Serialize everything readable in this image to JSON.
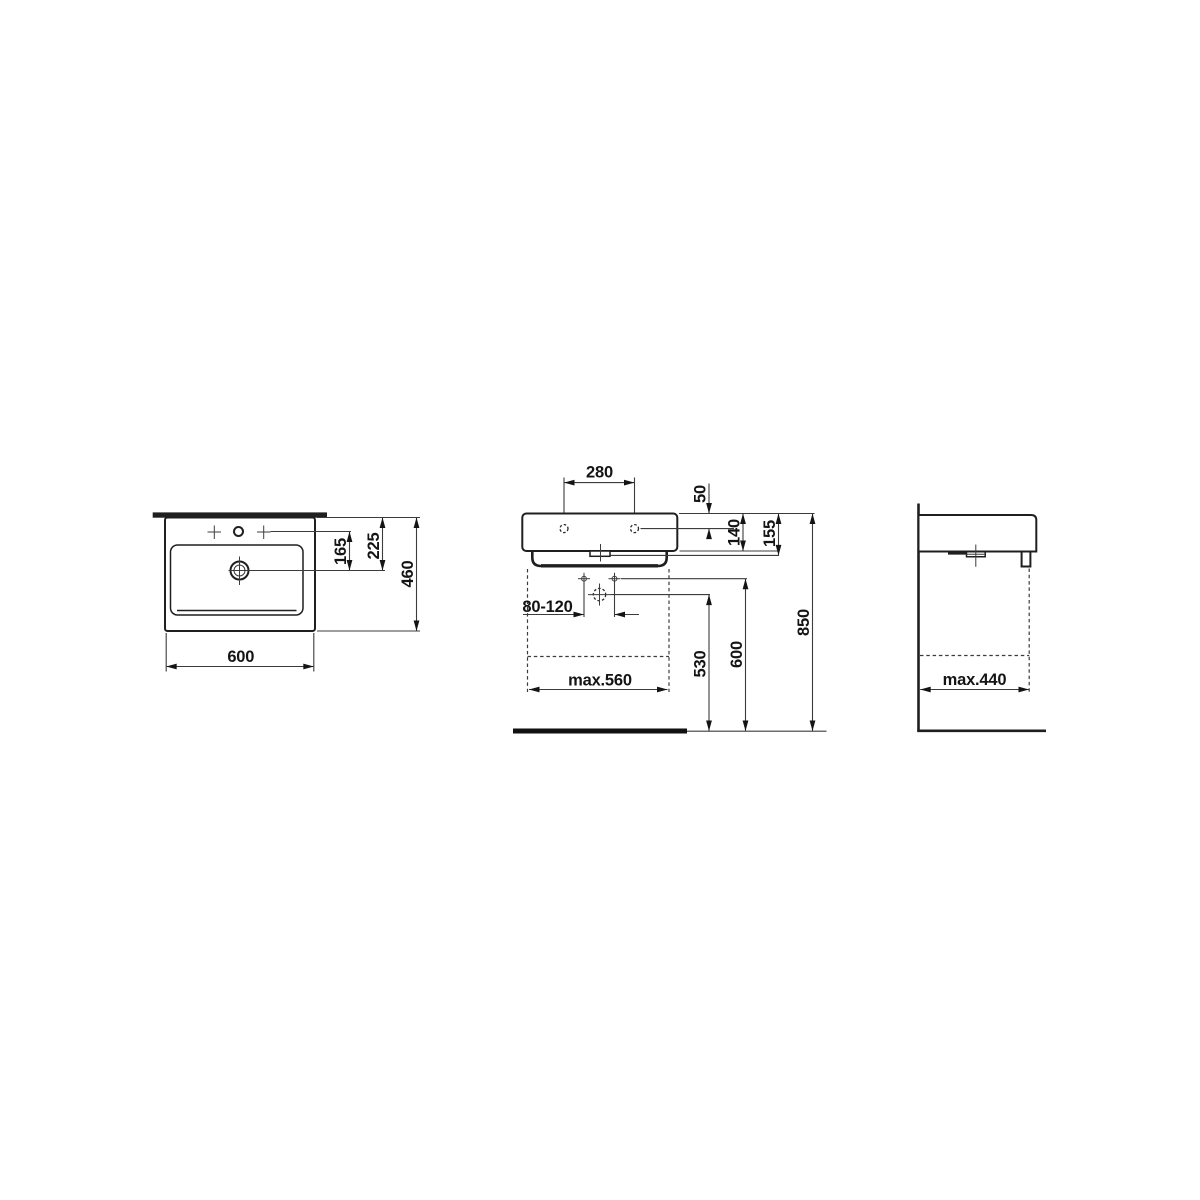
{
  "page": {
    "background": "#ffffff"
  },
  "drawing": {
    "colors": {
      "outline": "#1f1f1f",
      "dimension_lines": "#3c3c3c",
      "text": "#141414"
    },
    "views": {
      "plan": {
        "dims": {
          "overall_width": "600",
          "overall_depth": "460",
          "rim_to_drain": "225",
          "tap_line_to_drain": "165"
        }
      },
      "front": {
        "dims": {
          "tap_hole_spacing": "280",
          "rim_to_tap_line": "50",
          "bowl_height": "140",
          "total_height": "155",
          "fixing_span": "80-120",
          "max_width_clearance": "max.560",
          "drain_height": "530",
          "fixing_height": "600",
          "rim_height": "850"
        }
      },
      "side": {
        "dims": {
          "max_depth_clearance": "max.440"
        }
      }
    }
  }
}
